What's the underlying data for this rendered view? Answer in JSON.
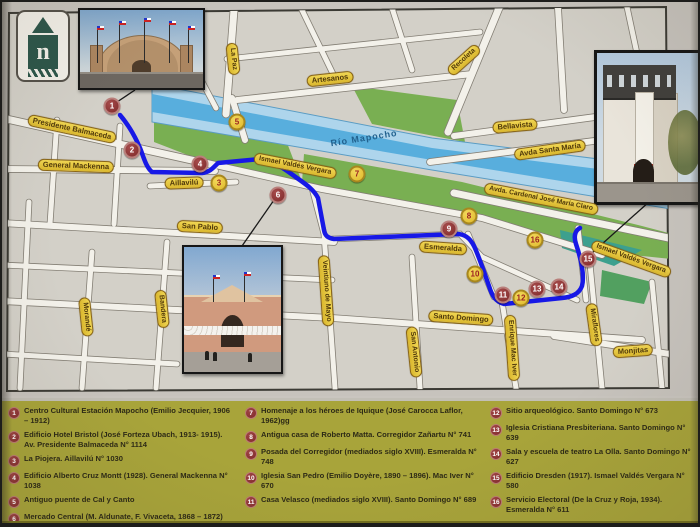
{
  "colors": {
    "marker_red": "#8e3434",
    "marker_yellow": "#e9c83f",
    "route_blue": "#1718e6",
    "legend_bg": "#a8a43a",
    "river_blue": "#58aedd",
    "park_green": "#79af52",
    "label_yellow": "#e6c63e"
  },
  "logo": {
    "letter": "n"
  },
  "map": {
    "river_label": {
      "text": "Río Mapocho",
      "x": 362,
      "y": 136,
      "rot": -9
    },
    "street_labels": [
      {
        "text": "Presidente Balmaceda",
        "x": 70,
        "y": 127,
        "rot": 12,
        "fs": 7.5
      },
      {
        "text": "General Mackenna",
        "x": 74,
        "y": 164,
        "rot": 2,
        "fs": 7.5
      },
      {
        "text": "Aillavilú",
        "x": 182,
        "y": 181,
        "rot": -2,
        "fs": 7.5
      },
      {
        "text": "San Pablo",
        "x": 198,
        "y": 225,
        "rot": 3,
        "fs": 7.5
      },
      {
        "text": "Morandé",
        "x": 84,
        "y": 315,
        "rot": 84,
        "fs": 7
      },
      {
        "text": "Bandera",
        "x": 160,
        "y": 307,
        "rot": 84,
        "fs": 7
      },
      {
        "text": "Veintiuno de Mayo",
        "x": 324,
        "y": 289,
        "rot": 86,
        "fs": 7
      },
      {
        "text": "La Paz",
        "x": 231,
        "y": 57,
        "rot": 84,
        "fs": 7
      },
      {
        "text": "Artesanos",
        "x": 328,
        "y": 77,
        "rot": -6,
        "fs": 7.5
      },
      {
        "text": "Recoleta",
        "x": 462,
        "y": 58,
        "rot": -42,
        "fs": 7
      },
      {
        "text": "Bellavista",
        "x": 513,
        "y": 124,
        "rot": -5,
        "fs": 7.5
      },
      {
        "text": "Avda  Santa María",
        "x": 548,
        "y": 148,
        "rot": -8,
        "fs": 7.5
      },
      {
        "text": "Ismael Valdés Vergara",
        "x": 293,
        "y": 164,
        "rot": 11,
        "fs": 7
      },
      {
        "text": "Avda. Cardenal José María Claro",
        "x": 539,
        "y": 197,
        "rot": 11,
        "fs": 6.8
      },
      {
        "text": "Esmeralda",
        "x": 441,
        "y": 246,
        "rot": 4,
        "fs": 7.5
      },
      {
        "text": "Santo Domingo",
        "x": 459,
        "y": 316,
        "rot": 4,
        "fs": 7.5
      },
      {
        "text": "San Antonio",
        "x": 412,
        "y": 350,
        "rot": 84,
        "fs": 7
      },
      {
        "text": "Enrique Mac Iver",
        "x": 510,
        "y": 346,
        "rot": 86,
        "fs": 7
      },
      {
        "text": "Miraflores",
        "x": 592,
        "y": 323,
        "rot": 82,
        "fs": 7
      },
      {
        "text": "Monjitas",
        "x": 631,
        "y": 349,
        "rot": -4,
        "fs": 7.5
      },
      {
        "text": "Ismael Valdés Vergara",
        "x": 629,
        "y": 257,
        "rot": 20,
        "fs": 7
      }
    ],
    "markers": [
      {
        "num": "1",
        "x": 110,
        "y": 104,
        "variant": "red"
      },
      {
        "num": "2",
        "x": 130,
        "y": 148,
        "variant": "red"
      },
      {
        "num": "3",
        "x": 217,
        "y": 181,
        "variant": "yellow"
      },
      {
        "num": "4",
        "x": 198,
        "y": 162,
        "variant": "red"
      },
      {
        "num": "5",
        "x": 235,
        "y": 120,
        "variant": "yellow"
      },
      {
        "num": "6",
        "x": 276,
        "y": 193,
        "variant": "red"
      },
      {
        "num": "7",
        "x": 355,
        "y": 172,
        "variant": "yellow"
      },
      {
        "num": "8",
        "x": 467,
        "y": 214,
        "variant": "yellow"
      },
      {
        "num": "9",
        "x": 447,
        "y": 227,
        "variant": "red"
      },
      {
        "num": "10",
        "x": 473,
        "y": 272,
        "variant": "yellow"
      },
      {
        "num": "11",
        "x": 501,
        "y": 293,
        "variant": "red"
      },
      {
        "num": "12",
        "x": 519,
        "y": 296,
        "variant": "yellow"
      },
      {
        "num": "13",
        "x": 535,
        "y": 287,
        "variant": "red"
      },
      {
        "num": "14",
        "x": 557,
        "y": 285,
        "variant": "red"
      },
      {
        "num": "15",
        "x": 586,
        "y": 257,
        "variant": "red"
      },
      {
        "num": "16",
        "x": 533,
        "y": 238,
        "variant": "yellow"
      }
    ]
  },
  "legend": {
    "columns": [
      {
        "left": 6,
        "width": 227,
        "items": [
          {
            "num": "1",
            "text": "Centro Cultural Estación Mapocho (Emilio Jecquier, 1906 – 1912)"
          },
          {
            "num": "2",
            "text": "Edificio Hotel Bristol (José Forteza Ubach, 1913- 1915). Av. Presidente Balmaceda N° 1114"
          },
          {
            "num": "3",
            "text": "La Piojera. Aillavilú N° 1030"
          },
          {
            "num": "4",
            "text": "Edificio Alberto Cruz Montt (1928). General Mackenna N° 1038"
          },
          {
            "num": "5",
            "text": "Antiguo puente de Cal y Canto"
          },
          {
            "num": "6",
            "text": "Mercado Central (M. Aldunate, F. Vivaceta, 1868 – 1872)"
          }
        ]
      },
      {
        "left": 243,
        "width": 236,
        "items": [
          {
            "num": "7",
            "text": "Homenaje a los héroes de Iquique (José Carocca Laflor, 1962)gg"
          },
          {
            "num": "8",
            "text": "Antigua casa de Roberto Matta. Corregidor Zañartu N° 741"
          },
          {
            "num": "9",
            "text": "Posada del Corregidor (mediados siglo XVIII). Esmeralda N° 748"
          },
          {
            "num": "10",
            "text": "Iglesia San Pedro (Emilio Doyère, 1890 – 1896). Mac Iver N° 670"
          },
          {
            "num": "11",
            "text": "Casa Velasco (mediados siglo XVIII). Santo Domingo N° 689"
          }
        ]
      },
      {
        "left": 488,
        "width": 206,
        "items": [
          {
            "num": "12",
            "text": "Sitio arqueológico. Santo Domingo N° 673"
          },
          {
            "num": "13",
            "text": "Iglesia Cristiana Presbiteriana. Santo Domingo N° 639"
          },
          {
            "num": "14",
            "text": "Sala y escuela de teatro La Olla. Santo Domingo N° 627"
          },
          {
            "num": "15",
            "text": "Edificio Dresden (1917). Ismael Valdés Vergara N° 580"
          },
          {
            "num": "16",
            "text": "Servicio Electoral (De la Cruz y Roja, 1934). Esmeralda N° 611"
          }
        ]
      }
    ]
  }
}
